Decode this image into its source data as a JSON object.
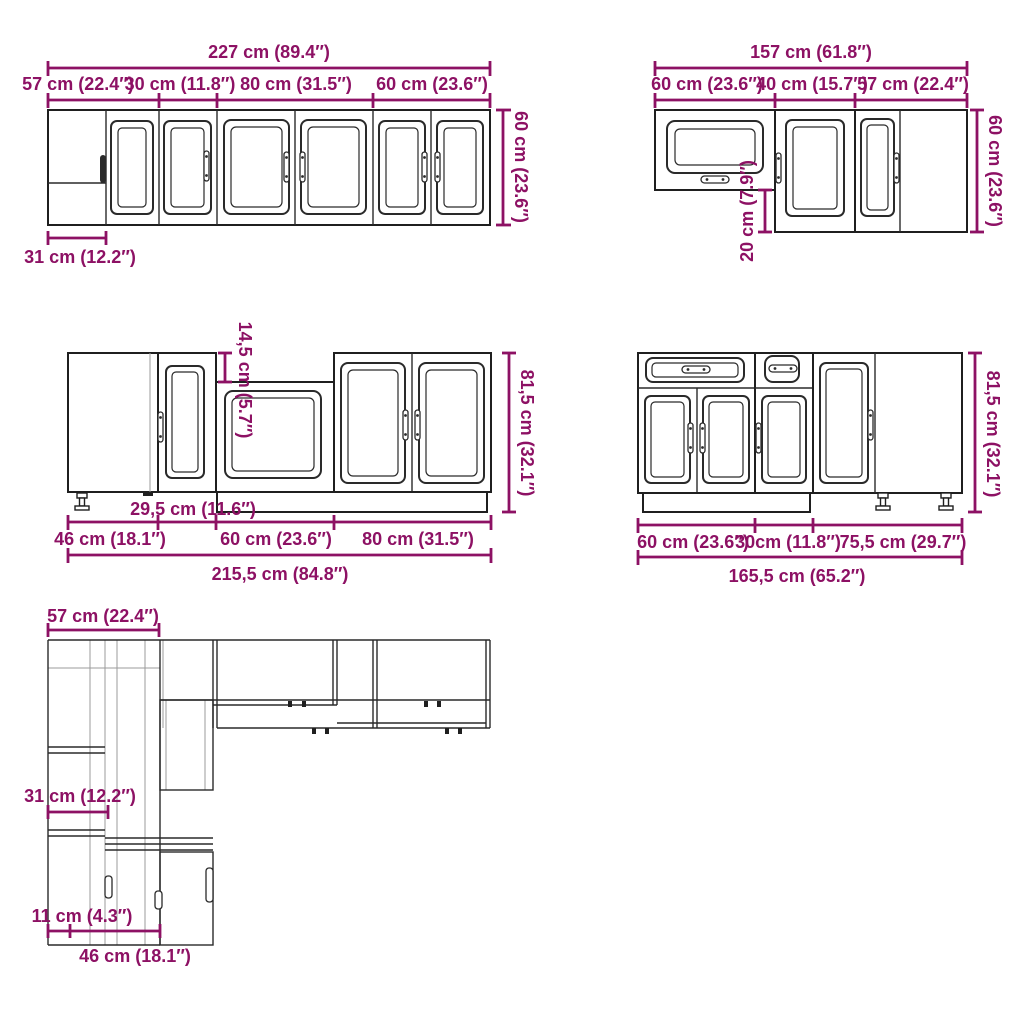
{
  "meta": {
    "description": "Kitchen cabinet set dimension diagram, front and plan views",
    "accent_color": "#8d1164",
    "line_color": "#1f1f1f",
    "background_color": "#ffffff"
  },
  "wall_run_a": {
    "total_width": "227 cm (89.4″)",
    "segment_widths": [
      "57 cm (22.4″)",
      "30 cm (11.8″)",
      "80 cm (31.5″)",
      "60 cm (23.6″)"
    ],
    "height": "60 cm (23.6″)",
    "corner_blind_width": "31 cm (12.2″)"
  },
  "wall_run_b": {
    "total_width": "157 cm (61.8″)",
    "segment_widths": [
      "60 cm (23.6″)",
      "40 cm (15.7″)",
      "57 cm (22.4″)"
    ],
    "height": "60 cm (23.6″)",
    "mounting_offset": "20 cm (7.9″)"
  },
  "base_run_a": {
    "total_width": "215,5 cm (84.8″)",
    "segment_widths": [
      "46 cm (18.1″)",
      "60 cm (23.6″)",
      "80 cm (31.5″)"
    ],
    "narrow_unit_width": "29,5 cm (11.6″)",
    "height": "81,5 cm (32.1″)",
    "worktop_recess": "14,5 cm (5.7″)"
  },
  "base_run_b": {
    "total_width": "165,5 cm (65.2″)",
    "segment_widths": [
      "60 cm (23.6″)",
      "30cm (11.8″)",
      "75,5 cm (29.7″)"
    ],
    "height": "81,5 cm (32.1″)"
  },
  "plan_view": {
    "corner_width": "57 cm (22.4″)",
    "wall_cabinet_depth": "31 cm (12.2″)",
    "gap_depth": "11 cm (4.3″)",
    "base_cabinet_depth": "46 cm (18.1″)"
  }
}
